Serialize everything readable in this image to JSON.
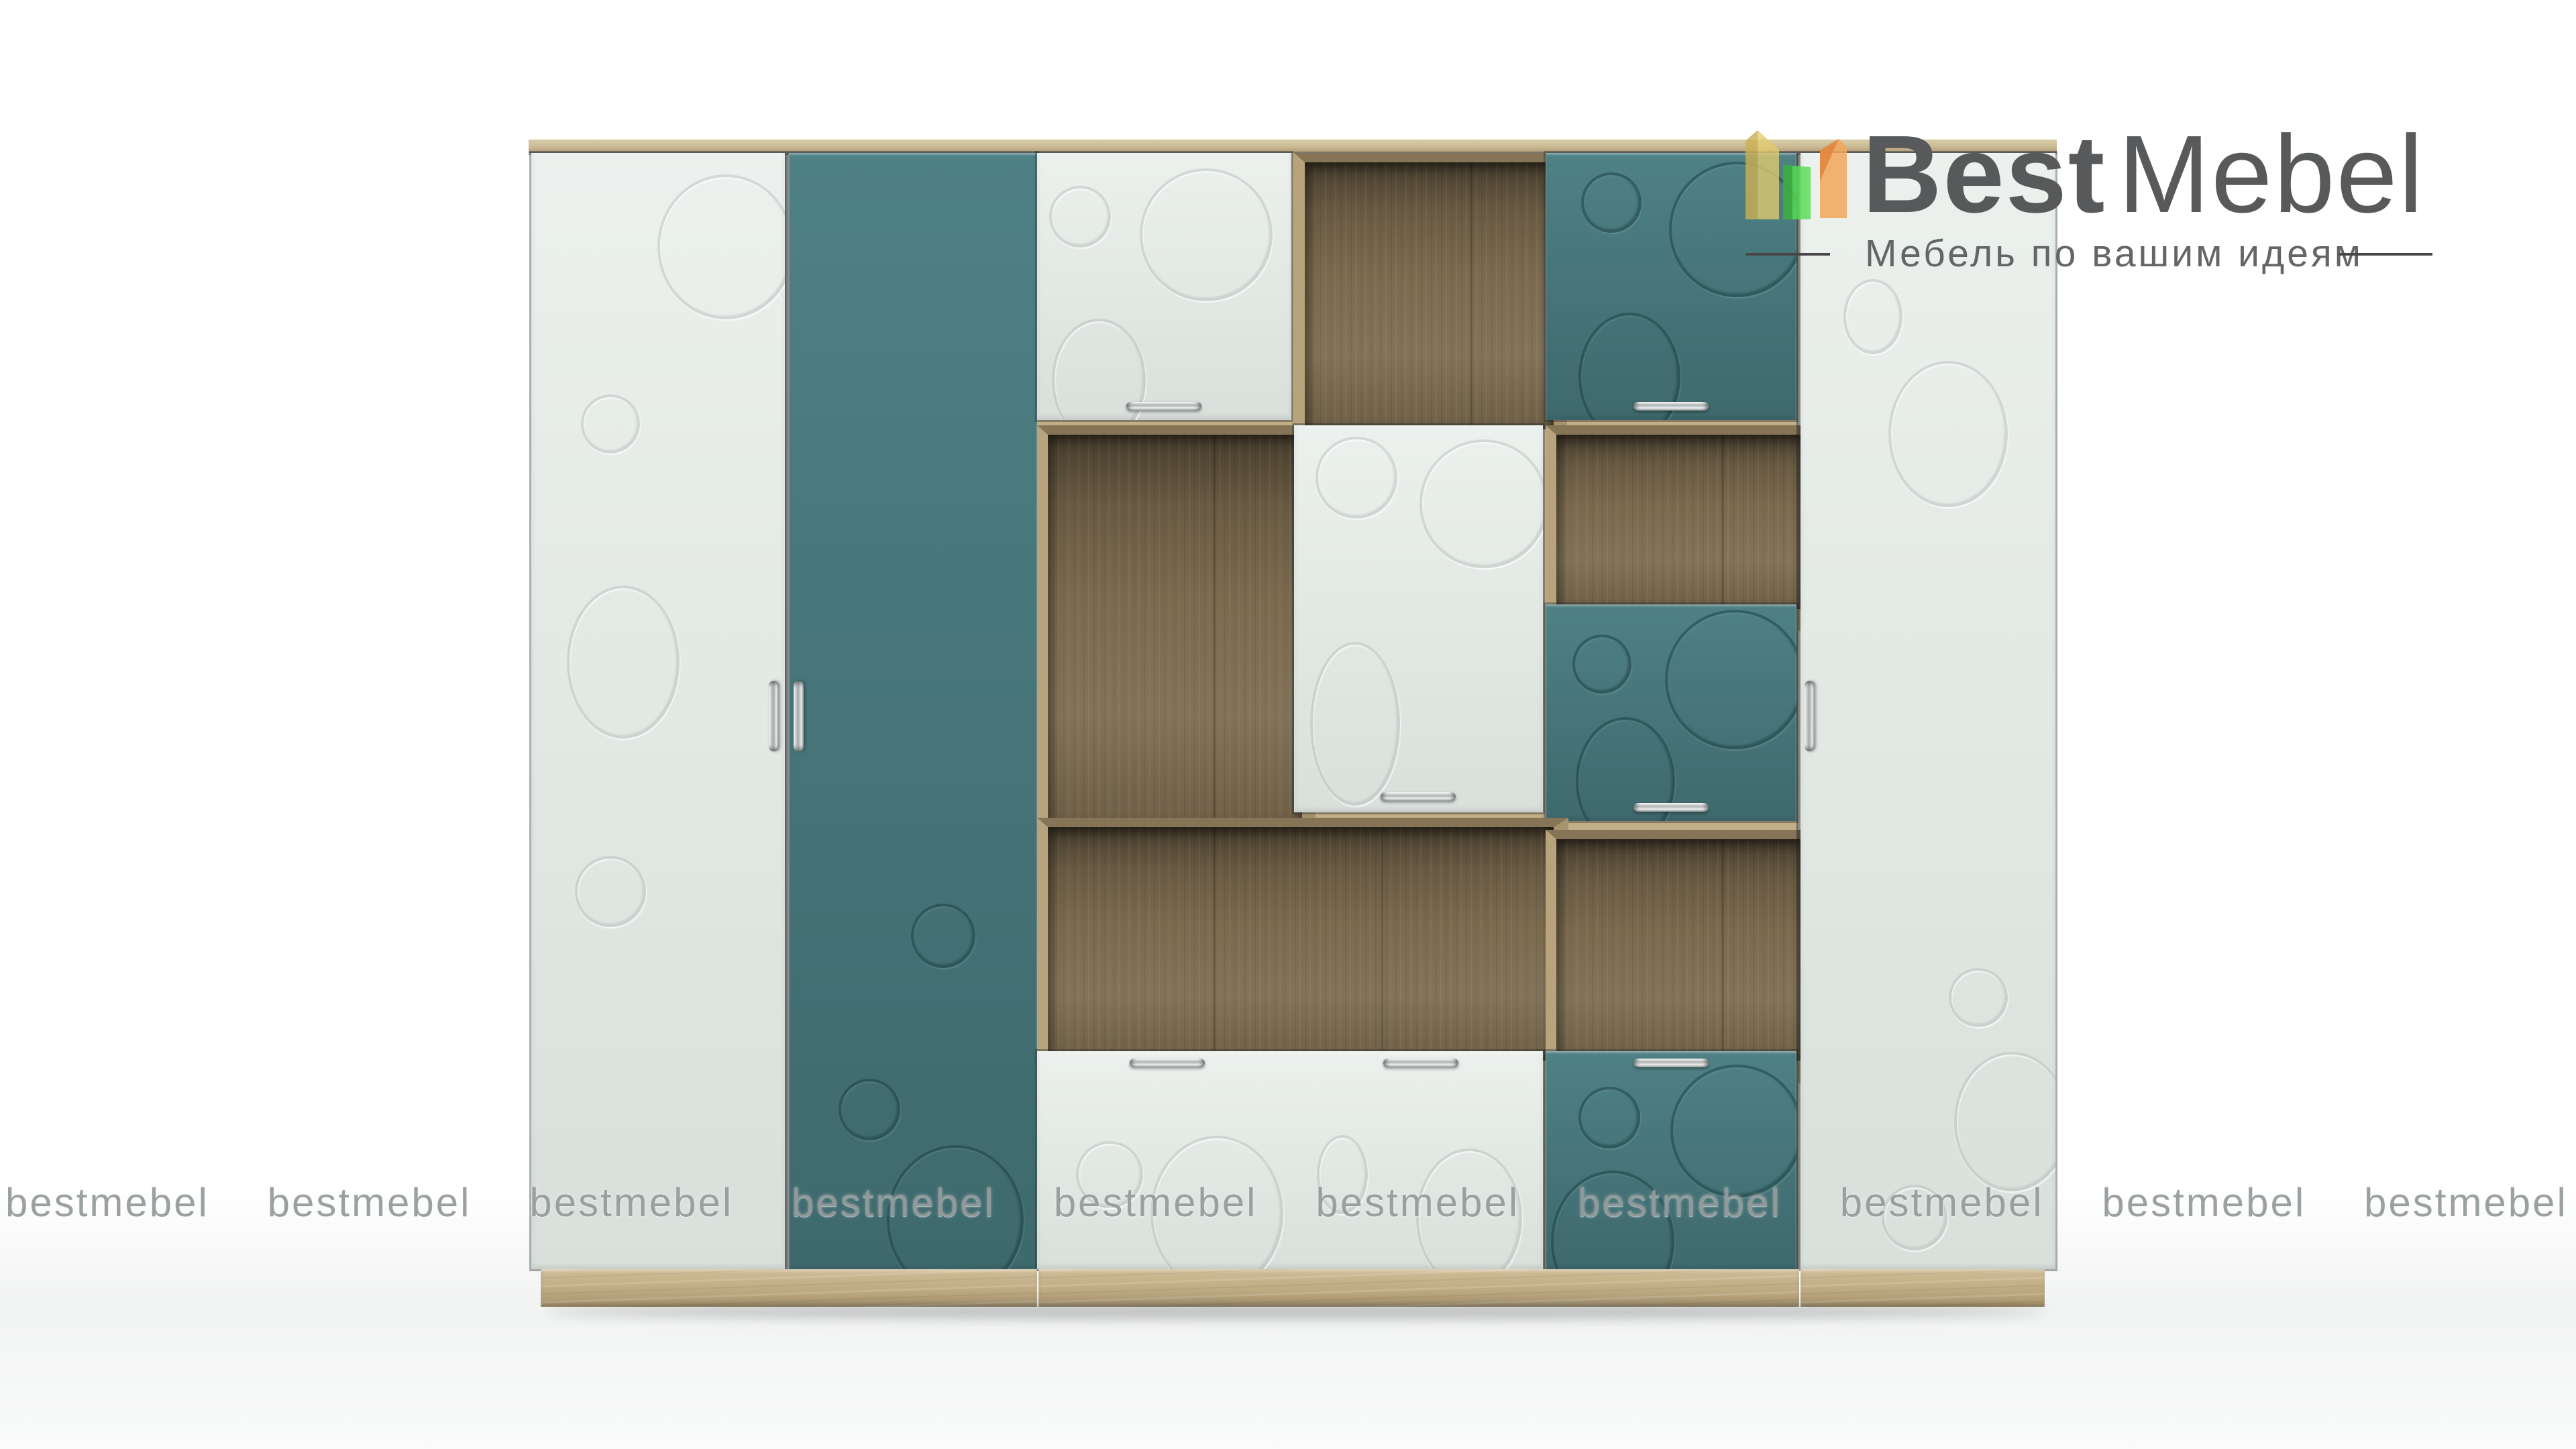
{
  "brand": {
    "name_part1": "Best",
    "name_part2": "Mebel",
    "tagline": "Мебель по вашим идеям"
  },
  "watermark": {
    "text": "bestmebel",
    "repeat_count": 10
  },
  "furniture": {
    "description_visible": "",
    "sections": {
      "left_wardrobe": [
        "white-door",
        "teal-door"
      ],
      "middle_shelving": [
        "white-door",
        "open-shelf",
        "teal-door",
        "open-shelf",
        "white-tall-door",
        "open-shelf",
        "teal-door",
        "wide-open-shelf",
        "open-shelf",
        "wide-white-door",
        "teal-door"
      ],
      "right_wardrobe": [
        "white-door"
      ]
    }
  },
  "palette": {
    "teal_door": "#477579",
    "white_door": "#e3e9e5",
    "oak_light": "#cdbc97",
    "oak_plinth": "#bfab83",
    "wood_interior": "#7b6a4e",
    "logo_text": "#58595b",
    "tagline_text": "#646566",
    "watermark_gray": "#8a9090",
    "icon_yellow": "#dec660",
    "icon_green": "#50d84e",
    "icon_orange": "#f0a055"
  }
}
